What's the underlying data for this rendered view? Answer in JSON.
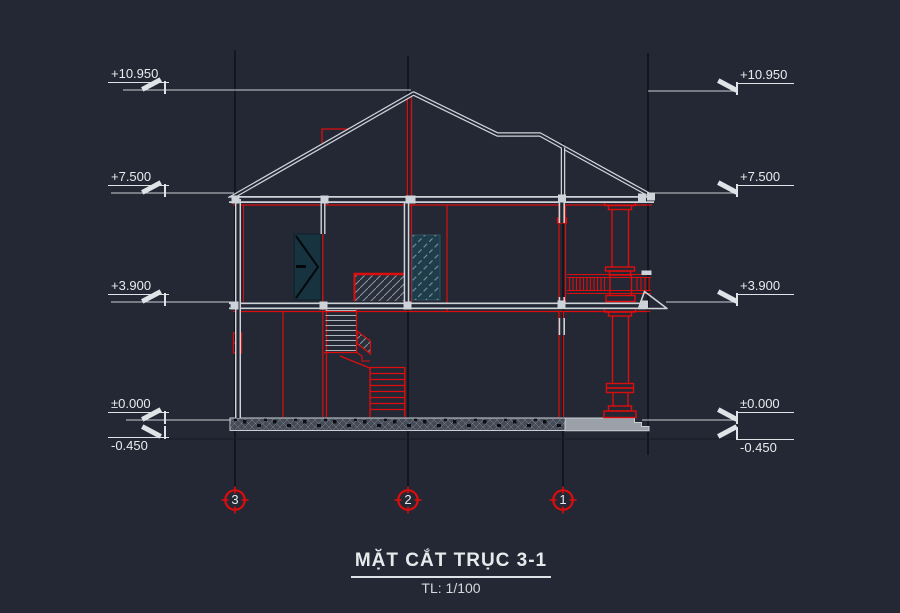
{
  "drawing": {
    "title": "MẶT CẮT TRỤC 3-1",
    "scale": "TL: 1/100",
    "levels_left": [
      {
        "label": "+10.950"
      },
      {
        "label": "+7.500"
      },
      {
        "label": "+3.900"
      },
      {
        "label": "±0.000"
      },
      {
        "label": "-0.450"
      }
    ],
    "levels_right": [
      {
        "label": "+10.950"
      },
      {
        "label": "+7.500"
      },
      {
        "label": "+3.900"
      },
      {
        "label": "±0.000"
      },
      {
        "label": "-0.450"
      }
    ],
    "axis_bubbles": [
      {
        "label": "3"
      },
      {
        "label": "2"
      },
      {
        "label": "1"
      }
    ],
    "colors": {
      "background": "#232834",
      "line_white": "#ced3d9",
      "accent_red": "#dd0d0d",
      "glass_teal": "#1e3c49",
      "door_teal": "#17333f",
      "axis_dark": "#07090e"
    }
  }
}
